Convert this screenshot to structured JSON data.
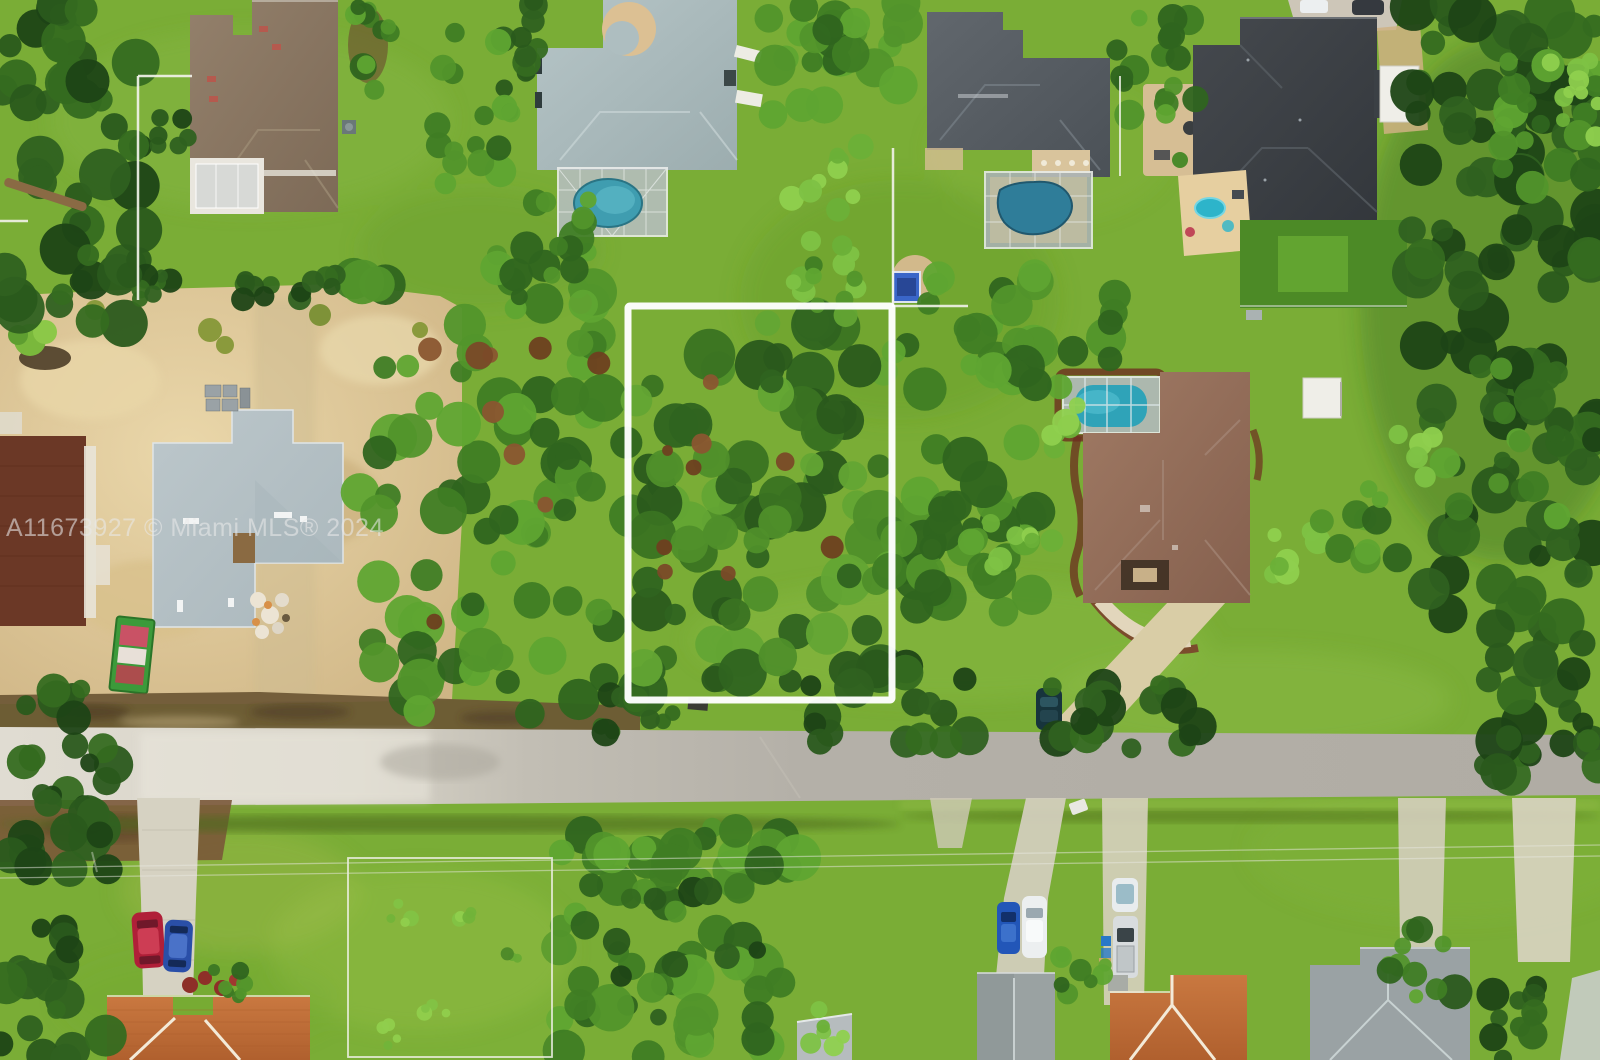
{
  "watermark": {
    "text": "A11673927 © Miami MLS® 2024"
  },
  "palette": {
    "lot_boundary": "#ffffff",
    "grass": "#7aad36",
    "road_asphalt": "#b4b0a8",
    "road_light": "#e0dcd2",
    "sand": "#d9c391",
    "pool_teal": "#3f9db0",
    "pool_dark": "#2f7d99",
    "roof_brown": "#897662",
    "roof_teal_gray": "#aebec0",
    "roof_dark_gray": "#565c62",
    "roof_charcoal": "#3c4146",
    "roof_mauve": "#96705c",
    "roof_terracotta": "#c0703a",
    "roof_gray": "#9aa2a2",
    "mulch_red": "#6e2e20",
    "turf_dark": "#4c8a26"
  }
}
